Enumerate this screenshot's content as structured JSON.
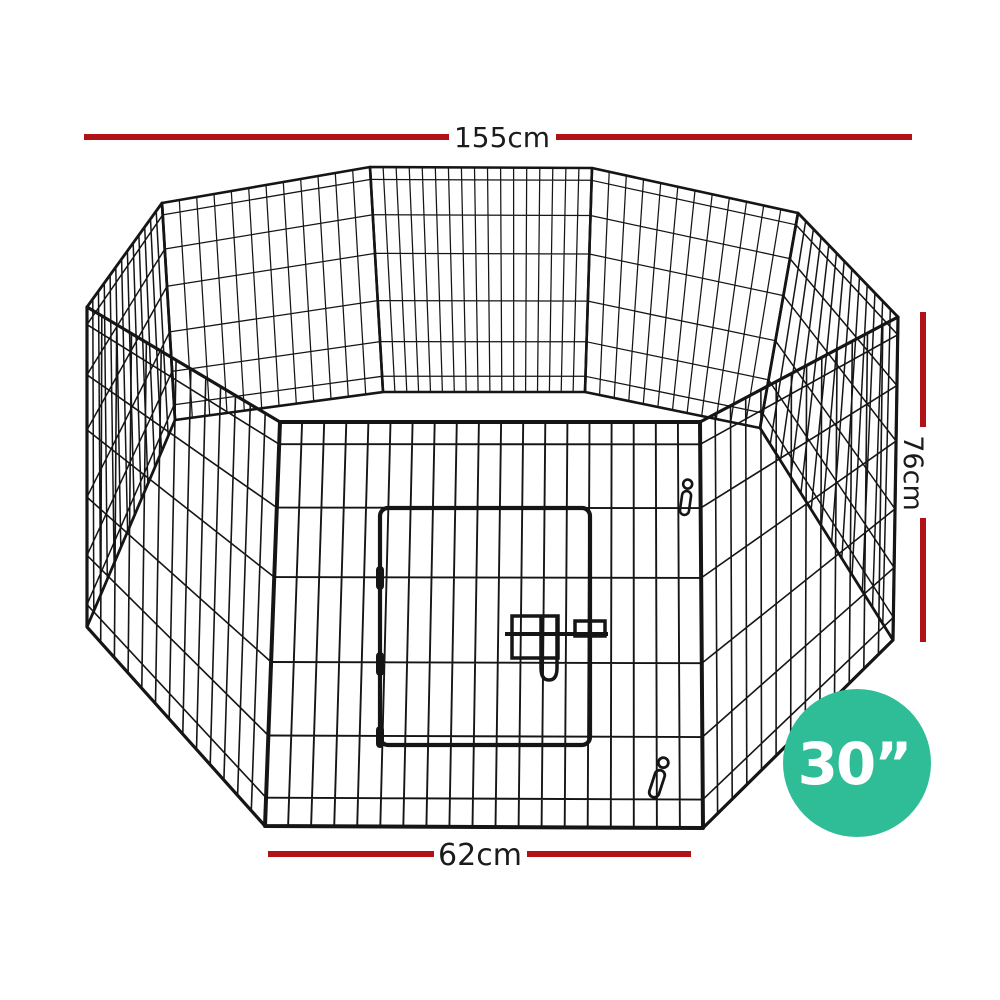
{
  "product": {
    "badge": {
      "label": "30”"
    },
    "dimensions": {
      "overall_width": "155cm",
      "panel_height": "76cm",
      "panel_width": "62cm"
    }
  },
  "icons": {
    "snap_hook_top": "carabiner-clip",
    "snap_hook_bottom": "carabiner-clip"
  },
  "colors": {
    "dimension_line": "#b01218",
    "annotation_text": "#1b1b1b",
    "badge_fill": "#2ebd96",
    "badge_text": "#ffffff",
    "wire": "#151515",
    "background": "#ffffff"
  }
}
